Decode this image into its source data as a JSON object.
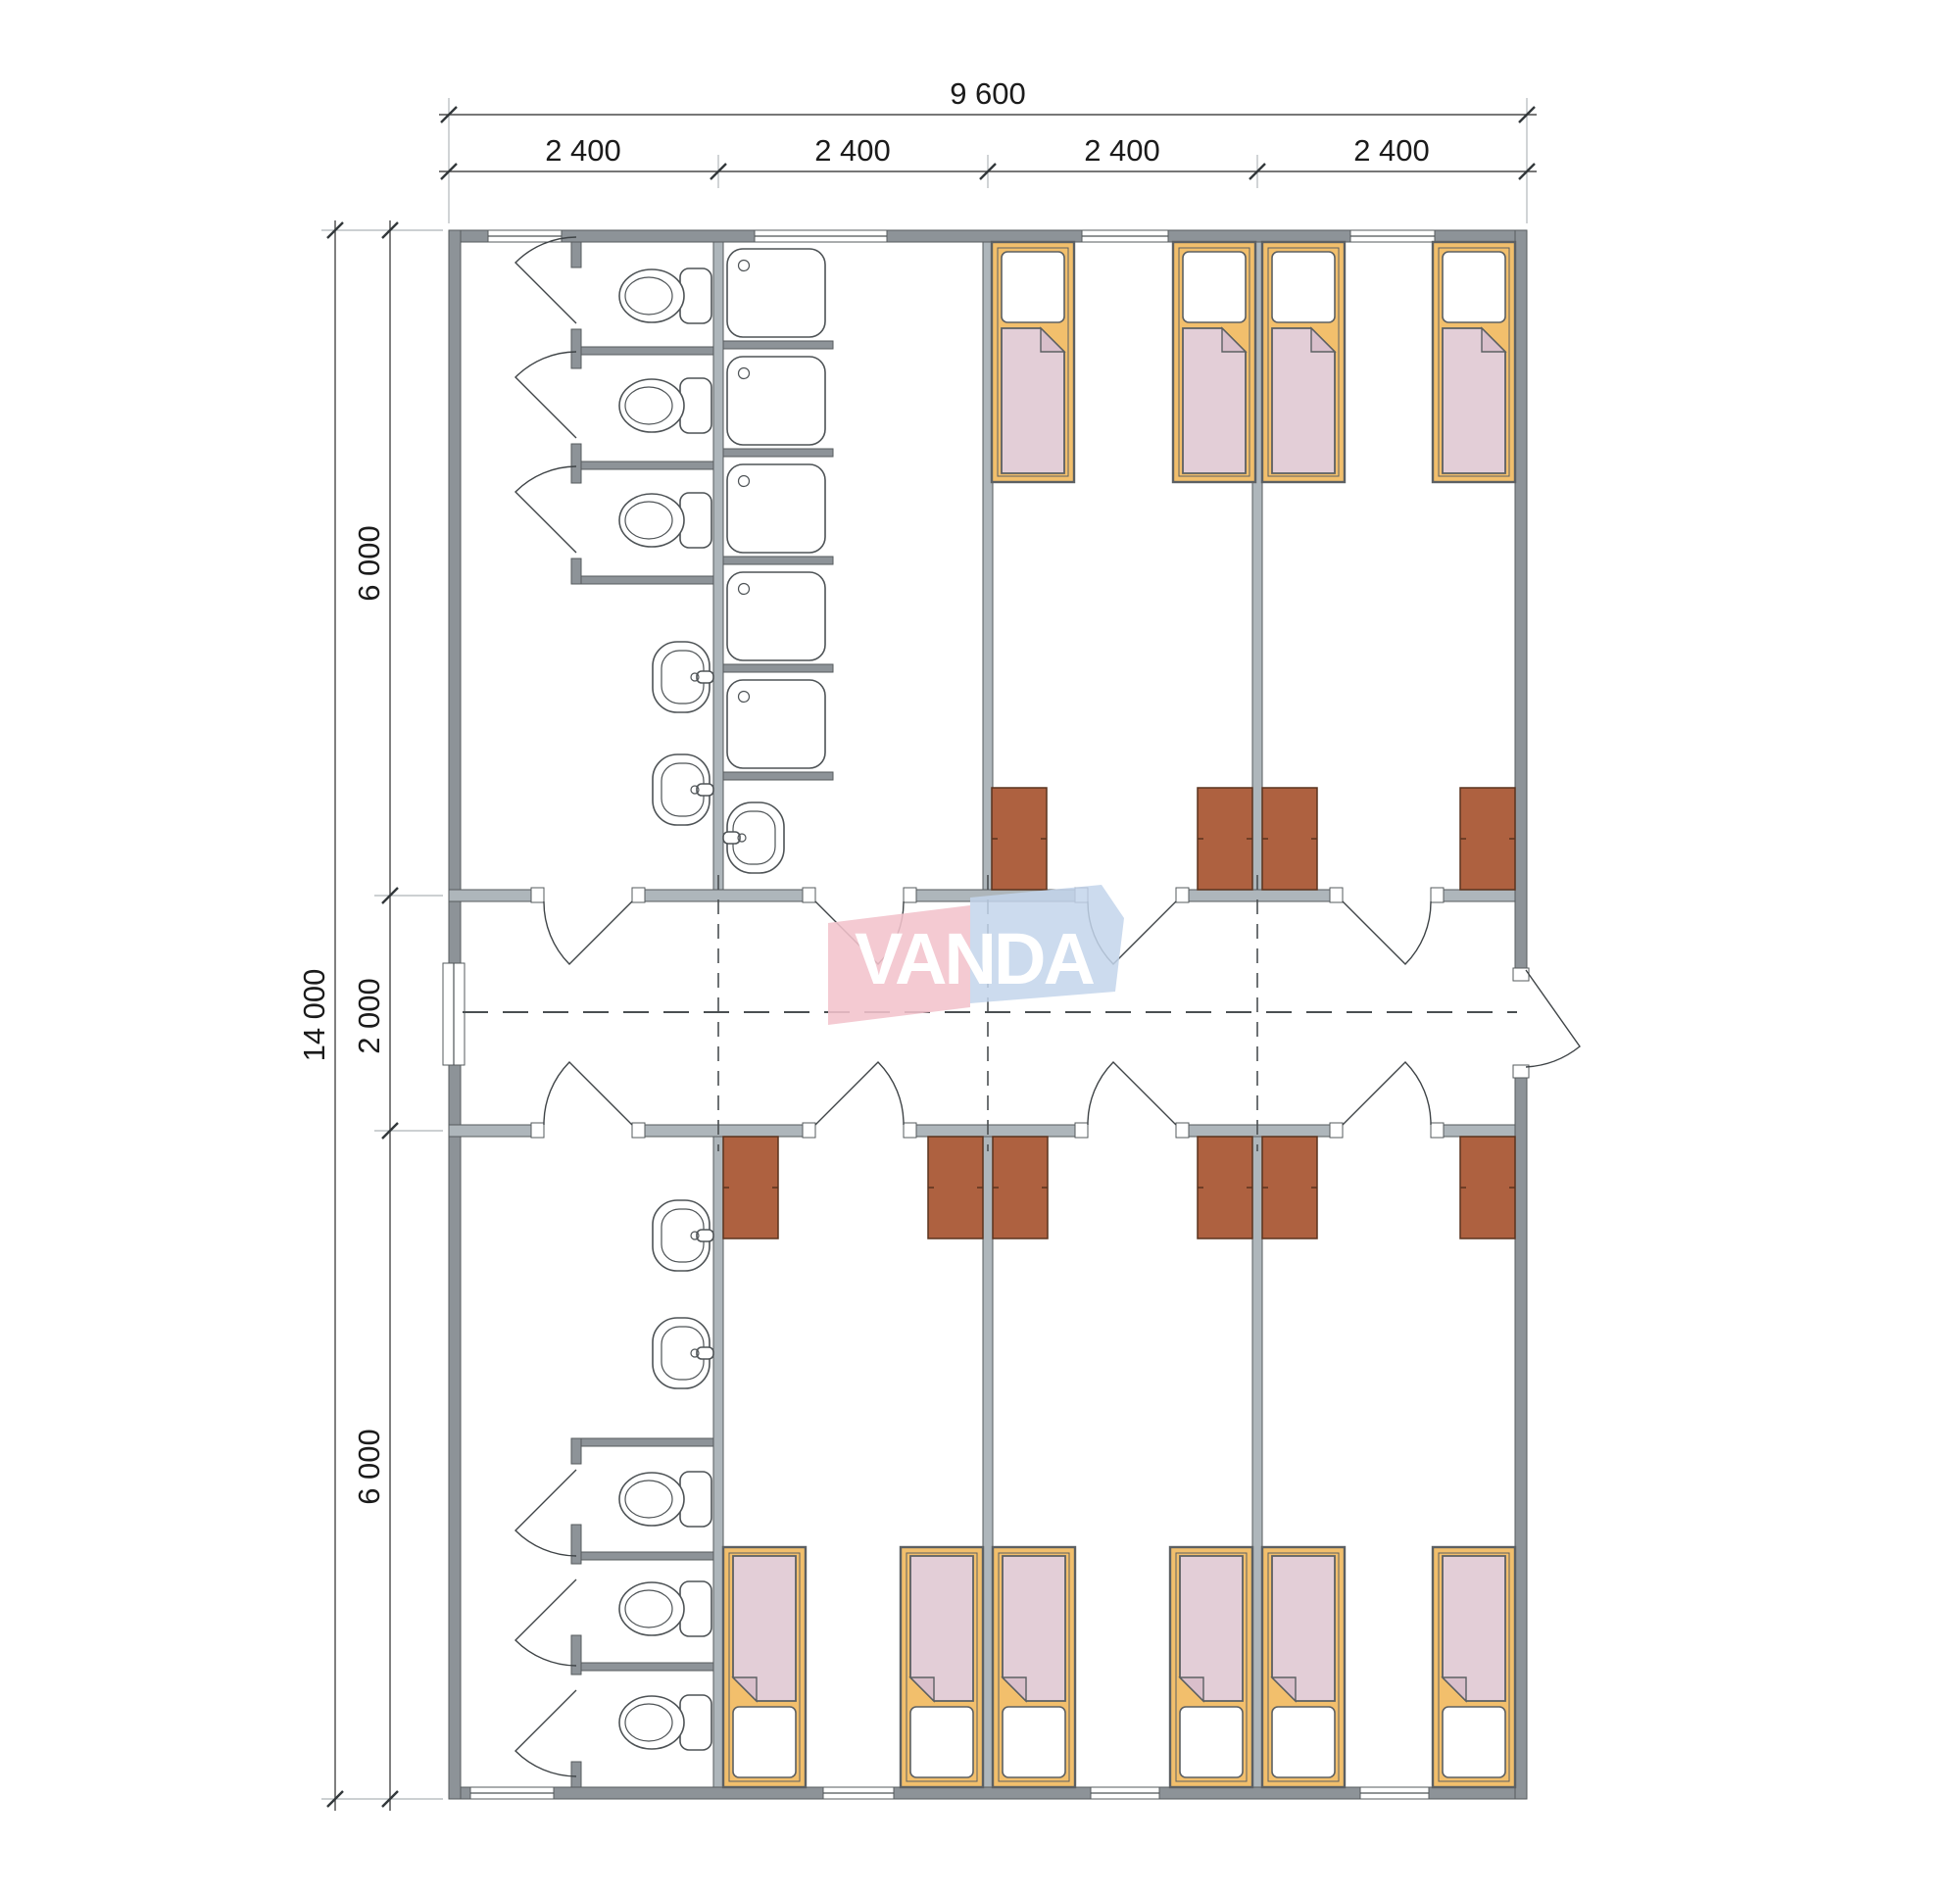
{
  "meta": {
    "drawing_type": "architectural floor plan",
    "brand": "VANDA",
    "units": "millimetres"
  },
  "logo": {
    "text": "VANDA"
  },
  "dimensions": {
    "top": {
      "total": "9 600",
      "segments": [
        "2 400",
        "2 400",
        "2 400",
        "2 400"
      ]
    },
    "left": {
      "total": "14 000",
      "segments": [
        "6 000",
        "2 000",
        "6 000"
      ]
    }
  },
  "colors": {
    "wall": "#8d9398",
    "wallLight": "#aeb6bb",
    "lineDark": "#4e5356",
    "bedFrame": "#f2bf6c",
    "blanket": "#e3ced7",
    "blanketFold": "#d9bfcb",
    "wardrobe": "#ae6140",
    "logoPink": "#f2c3cc",
    "logoBlue": "#c3d5eb",
    "dimText": "#1b1b1b",
    "dashLine": "#4a4f52"
  },
  "fixtures": {
    "toilets": 6,
    "showers": 5,
    "sinks": 5,
    "beds": 10,
    "wardrobes": 10,
    "room_doors": 8,
    "stall_doors": 6,
    "windows": 9,
    "entrance_doors": 1
  }
}
